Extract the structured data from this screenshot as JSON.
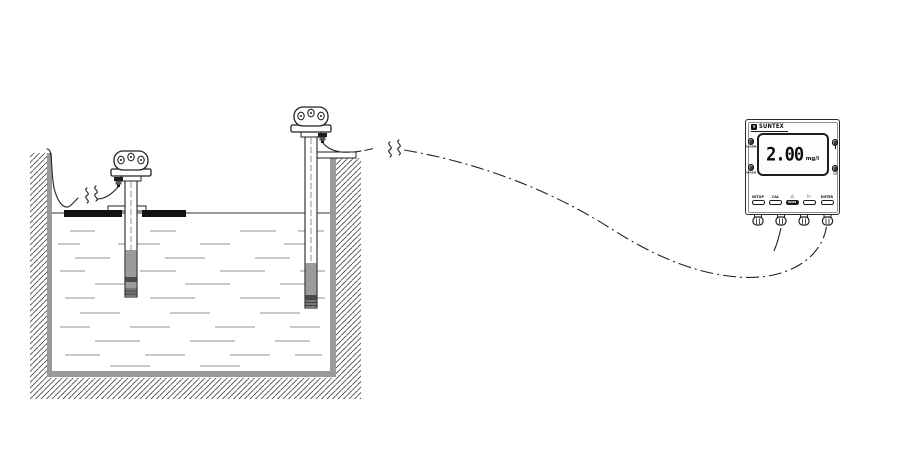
{
  "meter": {
    "brand": "SUNTEX",
    "logo_letter": "S",
    "display": {
      "value": "2.00",
      "unit": "mg/l"
    },
    "indicators": [
      {
        "label": "ALARM"
      },
      {
        "label": "WASH"
      },
      {
        "label": ""
      },
      {
        "label": "LO"
      }
    ],
    "buttons": [
      {
        "label": "SETUP"
      },
      {
        "label": "CAL"
      },
      {
        "label": "△",
        "pill_text": "MODE"
      },
      {
        "label": "▷"
      },
      {
        "label": "ENTER"
      }
    ]
  },
  "colors": {
    "line": "#222222",
    "wall_gray": "#9a9a9a",
    "hatch": "#4a4a4a",
    "sensor_gray": "#9b9b9b",
    "sensor_band": "#4a4a4a",
    "float_black": "#121212",
    "water_dash": "#a8a8a8"
  }
}
